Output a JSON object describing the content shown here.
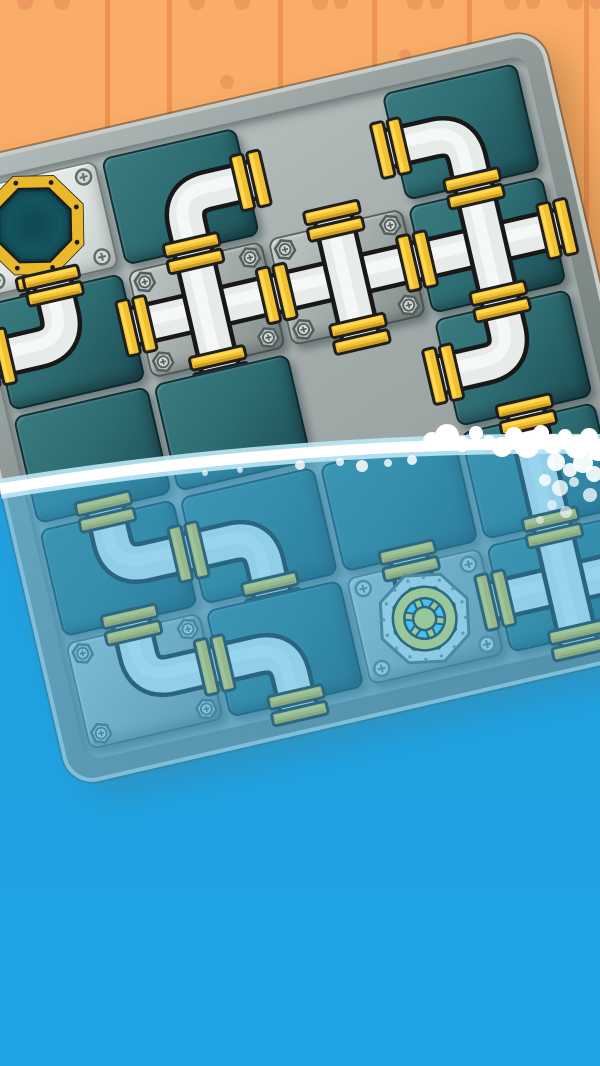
{
  "scene": {
    "width": 600,
    "height": 1066,
    "name": "pipe-slide-puzzle-game"
  },
  "background": {
    "wood_color": "#F9AD68",
    "plank_line_color": "#EF9350",
    "nail_color": "#EE9A5F",
    "plank_lines_x": [
      105,
      167,
      278,
      372,
      467,
      584
    ],
    "nails": [
      {
        "x": 25,
        "y": 2,
        "r": 8
      },
      {
        "x": 62,
        "y": 2,
        "r": 8
      },
      {
        "x": 197,
        "y": 2,
        "r": 8
      },
      {
        "x": 242,
        "y": 2,
        "r": 8
      },
      {
        "x": 320,
        "y": 2,
        "r": 8
      },
      {
        "x": 341,
        "y": 2,
        "r": 7
      },
      {
        "x": 415,
        "y": 2,
        "r": 8
      },
      {
        "x": 437,
        "y": 2,
        "r": 7
      },
      {
        "x": 512,
        "y": 2,
        "r": 8
      },
      {
        "x": 533,
        "y": 2,
        "r": 7
      },
      {
        "x": 575,
        "y": 2,
        "r": 8
      },
      {
        "x": 596,
        "y": 2,
        "r": 7
      },
      {
        "x": 227,
        "y": 82,
        "r": 7
      },
      {
        "x": 405,
        "y": 55,
        "r": 6
      }
    ]
  },
  "board": {
    "left": -73,
    "top": 170,
    "width": 622,
    "height": 626,
    "rotation_deg": -13,
    "cols": 4,
    "rows": 5,
    "tile_w": 138,
    "tile_h": 110,
    "gap": 6,
    "surface_pad": 6
  },
  "palette": {
    "pipe_outline": "#181818",
    "pipe_fill": "#E7ECEA",
    "pipe_highlight": "#F8FAF9",
    "gold": "#F2C12F",
    "gold_light": "#FFDA55",
    "gold_dark": "#C8961B",
    "port_ring": "#E9B82B",
    "port_hole_mid": "#14545E",
    "port_hole_dark": "#0C3840",
    "valve_blue": "#4FD2FF",
    "valve_frame": "#DFE5E3",
    "wheel": "#F5DE4F",
    "screw_fill": "#D3D9D7",
    "screw_line": "#636E6C",
    "bolt_fill": "#B9C1BF",
    "bolt_line": "#545E5C"
  },
  "water": {
    "surface_path": "M0,489 Q300,440 600,444",
    "solid_fill_path": "M0,489 Q300,440 600,444 L600,1066 L0,1066 Z",
    "solid_top": "#0690D4",
    "solid_bottom": "#0098E8",
    "tint_color": "rgba(60,175,230,0.5)",
    "line_color": "#FFFFFF",
    "line_soft_color": "rgba(190,232,246,0.9)",
    "foam": [
      {
        "x": 432,
        "y": 441,
        "r": 9
      },
      {
        "x": 447,
        "y": 436,
        "r": 12
      },
      {
        "x": 462,
        "y": 444,
        "r": 8
      },
      {
        "x": 476,
        "y": 433,
        "r": 7
      },
      {
        "x": 489,
        "y": 441,
        "r": 6
      },
      {
        "x": 502,
        "y": 447,
        "r": 10
      },
      {
        "x": 514,
        "y": 436,
        "r": 9
      },
      {
        "x": 527,
        "y": 445,
        "r": 13
      },
      {
        "x": 541,
        "y": 433,
        "r": 8
      },
      {
        "x": 553,
        "y": 444,
        "r": 10
      },
      {
        "x": 565,
        "y": 436,
        "r": 7
      },
      {
        "x": 577,
        "y": 447,
        "r": 12
      },
      {
        "x": 589,
        "y": 437,
        "r": 9
      },
      {
        "x": 598,
        "y": 450,
        "r": 11
      },
      {
        "x": 556,
        "y": 462,
        "r": 9,
        "o": 0.95
      },
      {
        "x": 570,
        "y": 470,
        "r": 7,
        "o": 0.9
      },
      {
        "x": 583,
        "y": 463,
        "r": 10,
        "o": 0.95
      },
      {
        "x": 594,
        "y": 474,
        "r": 8,
        "o": 0.9
      },
      {
        "x": 545,
        "y": 480,
        "r": 6,
        "o": 0.8
      },
      {
        "x": 560,
        "y": 488,
        "r": 8,
        "o": 0.8
      },
      {
        "x": 574,
        "y": 482,
        "r": 5,
        "o": 0.75
      },
      {
        "x": 590,
        "y": 495,
        "r": 7,
        "o": 0.75
      },
      {
        "x": 552,
        "y": 505,
        "r": 5,
        "o": 0.6
      },
      {
        "x": 566,
        "y": 512,
        "r": 6,
        "o": 0.6
      },
      {
        "x": 540,
        "y": 520,
        "r": 4,
        "o": 0.5
      },
      {
        "x": 300,
        "y": 465,
        "r": 5,
        "o": 0.8
      },
      {
        "x": 340,
        "y": 462,
        "r": 4,
        "o": 0.8
      },
      {
        "x": 362,
        "y": 466,
        "r": 6,
        "o": 0.85
      },
      {
        "x": 388,
        "y": 463,
        "r": 4,
        "o": 0.8
      },
      {
        "x": 412,
        "y": 460,
        "r": 5,
        "o": 0.85
      },
      {
        "x": 240,
        "y": 470,
        "r": 3,
        "o": 0.7
      },
      {
        "x": 205,
        "y": 473,
        "r": 3,
        "o": 0.7
      }
    ]
  },
  "tiles": [
    {
      "row": 1,
      "col": 1,
      "kind": "start",
      "material": "plateLight",
      "pipe": "stub-bottom",
      "fixed": true
    },
    {
      "row": 1,
      "col": 2,
      "kind": "pipe",
      "material": "teal",
      "pipe": "elbow",
      "sides": [
        "right",
        "bottom"
      ]
    },
    {
      "row": 1,
      "col": 3,
      "kind": "empty"
    },
    {
      "row": 1,
      "col": 4,
      "kind": "pipe",
      "material": "teal",
      "pipe": "elbow",
      "sides": [
        "left",
        "bottom"
      ]
    },
    {
      "row": 2,
      "col": 1,
      "kind": "pipe",
      "material": "teal",
      "pipe": "elbow",
      "sides": [
        "top",
        "left"
      ]
    },
    {
      "row": 2,
      "col": 2,
      "kind": "pipe",
      "material": "plate",
      "pipe": "cross",
      "fixed": true
    },
    {
      "row": 2,
      "col": 3,
      "kind": "pipe",
      "material": "plate",
      "pipe": "cross",
      "fixed": true
    },
    {
      "row": 2,
      "col": 4,
      "kind": "pipe",
      "material": "teal",
      "pipe": "cross"
    },
    {
      "row": 3,
      "col": 1,
      "kind": "blank",
      "material": "teal"
    },
    {
      "row": 3,
      "col": 2,
      "kind": "blank",
      "material": "teal"
    },
    {
      "row": 3,
      "col": 3,
      "kind": "empty"
    },
    {
      "row": 3,
      "col": 4,
      "kind": "pipe",
      "material": "teal",
      "pipe": "elbow",
      "sides": [
        "top",
        "left"
      ]
    },
    {
      "row": 4,
      "col": 1,
      "kind": "pipe",
      "material": "teal",
      "pipe": "elbow",
      "sides": [
        "top",
        "right"
      ]
    },
    {
      "row": 4,
      "col": 2,
      "kind": "pipe",
      "material": "teal",
      "pipe": "elbow",
      "sides": [
        "left",
        "bottom"
      ]
    },
    {
      "row": 4,
      "col": 3,
      "kind": "blank",
      "material": "teal"
    },
    {
      "row": 4,
      "col": 4,
      "kind": "pipe",
      "material": "teal",
      "pipe": "straight-v"
    },
    {
      "row": 5,
      "col": 1,
      "kind": "pipe",
      "material": "plate",
      "pipe": "elbow",
      "sides": [
        "top",
        "right"
      ],
      "fixed": true
    },
    {
      "row": 5,
      "col": 2,
      "kind": "pipe",
      "material": "teal",
      "pipe": "elbow",
      "sides": [
        "left",
        "bottom"
      ]
    },
    {
      "row": 5,
      "col": 3,
      "kind": "valve",
      "material": "plate",
      "pipe": "stub-top",
      "fixed": true
    },
    {
      "row": 5,
      "col": 4,
      "kind": "pipe",
      "material": "teal",
      "pipe": "cross"
    }
  ]
}
